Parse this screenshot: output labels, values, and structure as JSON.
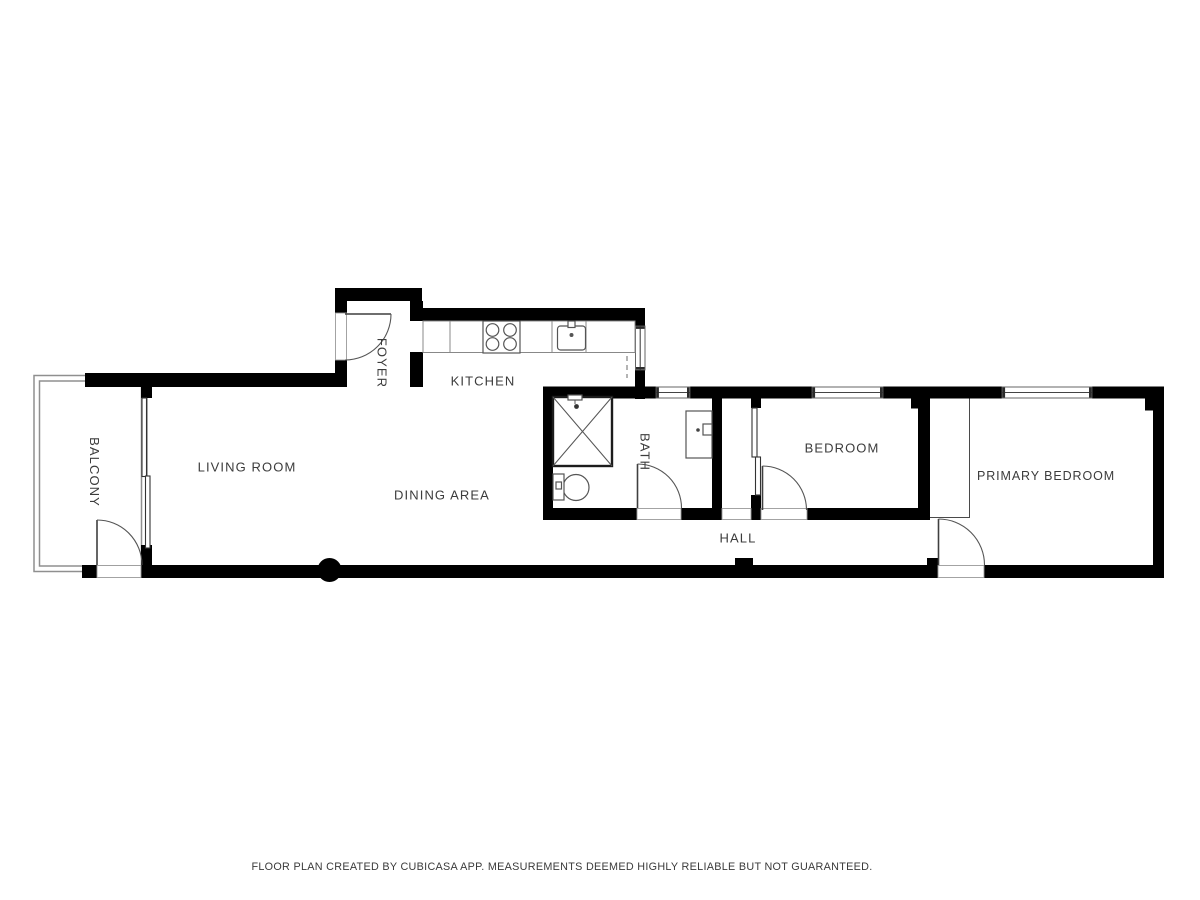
{
  "footer": {
    "disclaimer": "FLOOR PLAN CREATED BY CUBICASA APP. MEASUREMENTS DEEMED HIGHLY RELIABLE BUT NOT GUARANTEED."
  },
  "rooms": {
    "balcony": {
      "label": "BALCONY"
    },
    "living_room": {
      "label": "LIVING ROOM"
    },
    "dining_area": {
      "label": "DINING AREA"
    },
    "foyer": {
      "label": "FOYER"
    },
    "kitchen": {
      "label": "KITCHEN"
    },
    "bath": {
      "label": "BATH"
    },
    "hall": {
      "label": "HALL"
    },
    "bedroom": {
      "label": "BEDROOM"
    },
    "primary_bedroom": {
      "label": "PRIMARY BEDROOM"
    }
  },
  "fixtures": {
    "shower": "shower",
    "toilet": "toilet",
    "bathroom_sink": "bathroom-sink",
    "kitchen_sink": "kitchen-sink",
    "stove": "stove",
    "upper_cabinets": "upper-cabinets-dashed"
  },
  "colors": {
    "wall": "#000000",
    "label_text": "#3c3c3c",
    "fixture_line": "#555555",
    "counter_line": "#888888",
    "railing": "#8f8f8f",
    "background": "#ffffff"
  }
}
